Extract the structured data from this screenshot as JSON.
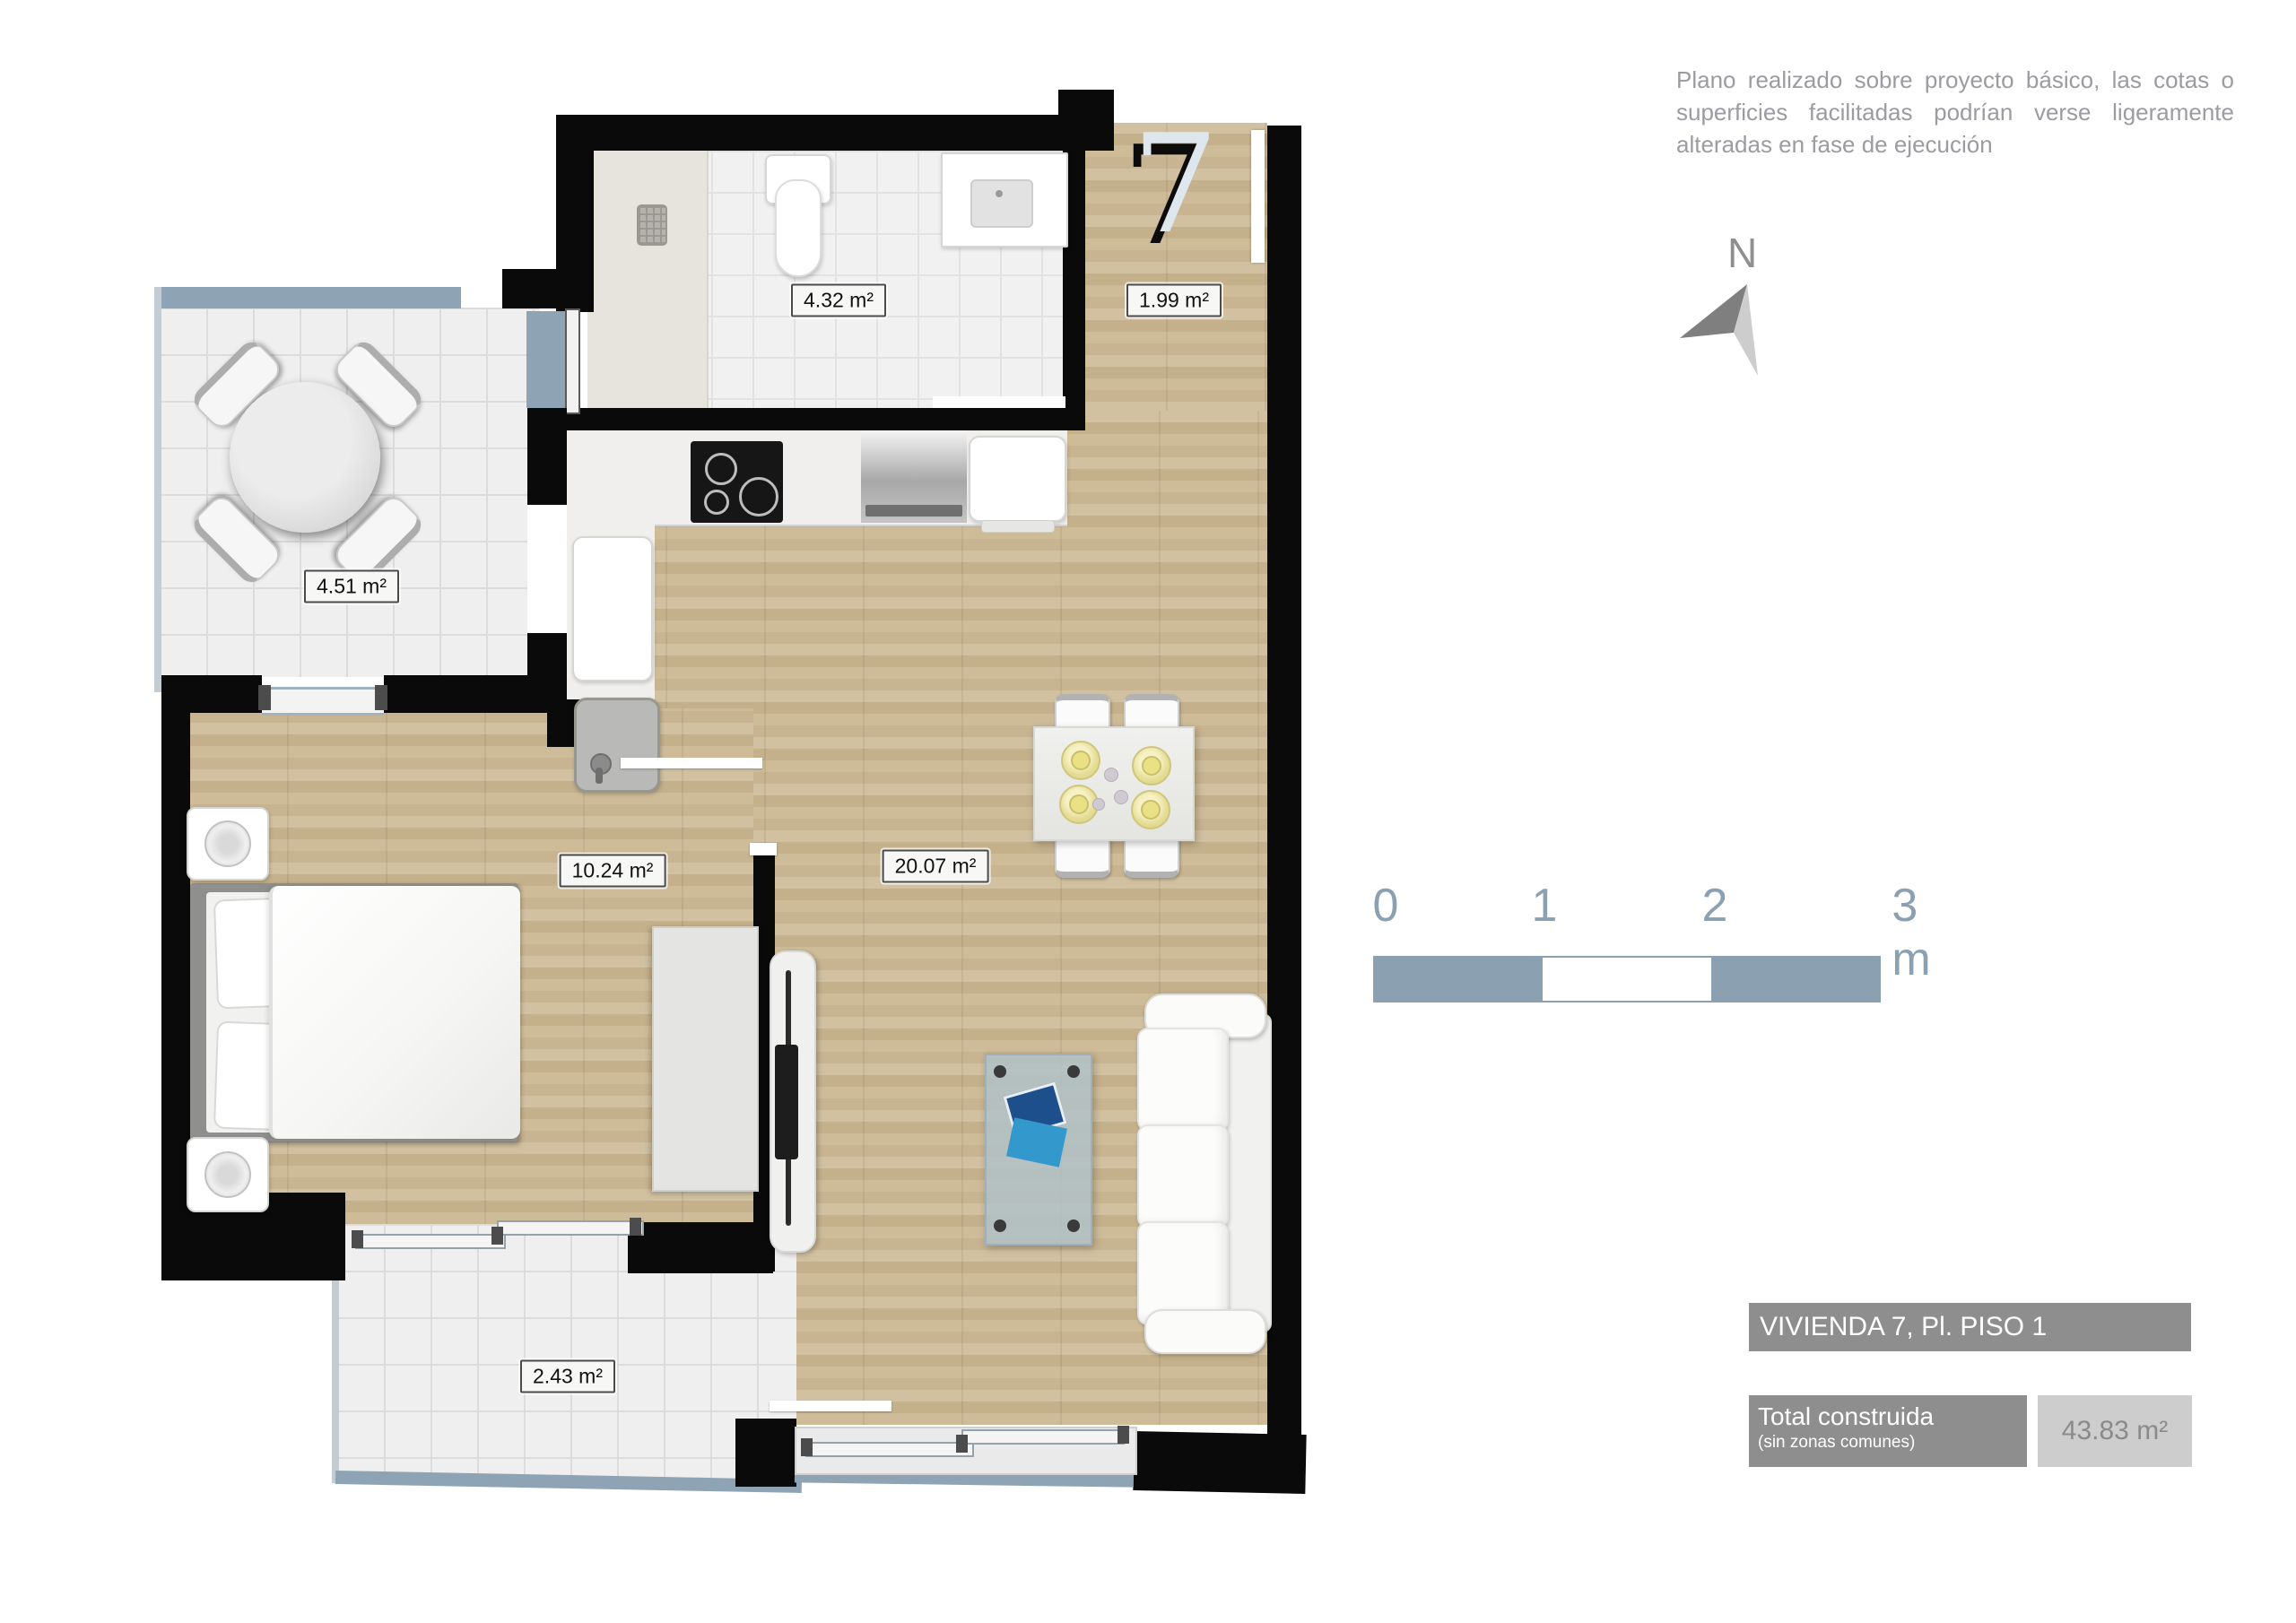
{
  "disclaimer": "Plano realizado sobre proyecto básico, las cotas o superficies facilitadas podrían verse ligeramente alteradas en fase de ejecución",
  "north": {
    "label": "N"
  },
  "unit_number": "7",
  "rooms": [
    {
      "name": "bathroom",
      "area": "4.32 m²"
    },
    {
      "name": "entry",
      "area": "1.99 m²"
    },
    {
      "name": "terrace",
      "area": "4.51 m²"
    },
    {
      "name": "bedroom",
      "area": "10.24 m²"
    },
    {
      "name": "living",
      "area": "20.07 m²"
    },
    {
      "name": "balcony",
      "area": "2.43 m²"
    }
  ],
  "scale_bar": {
    "ticks": [
      "0",
      "1",
      "2",
      "3 m"
    ]
  },
  "title_box": {
    "title": "VIVIENDA 7, Pl. PISO 1"
  },
  "total_box": {
    "label": "Total construida",
    "sublabel": "(sin zonas comunes)",
    "value": "43.83 m²"
  },
  "colors": {
    "wall": "#0a0a0a",
    "rail_blue": "#8ea4b4",
    "wood": "#c9b693",
    "tile": "#efefef",
    "label_border": "#4b4b4b",
    "annotation_grey": "#9b9ba1",
    "scale_blue": "#8ba0b0",
    "title_bg": "#8e8e8e",
    "value_bg": "#cdcdcd"
  }
}
